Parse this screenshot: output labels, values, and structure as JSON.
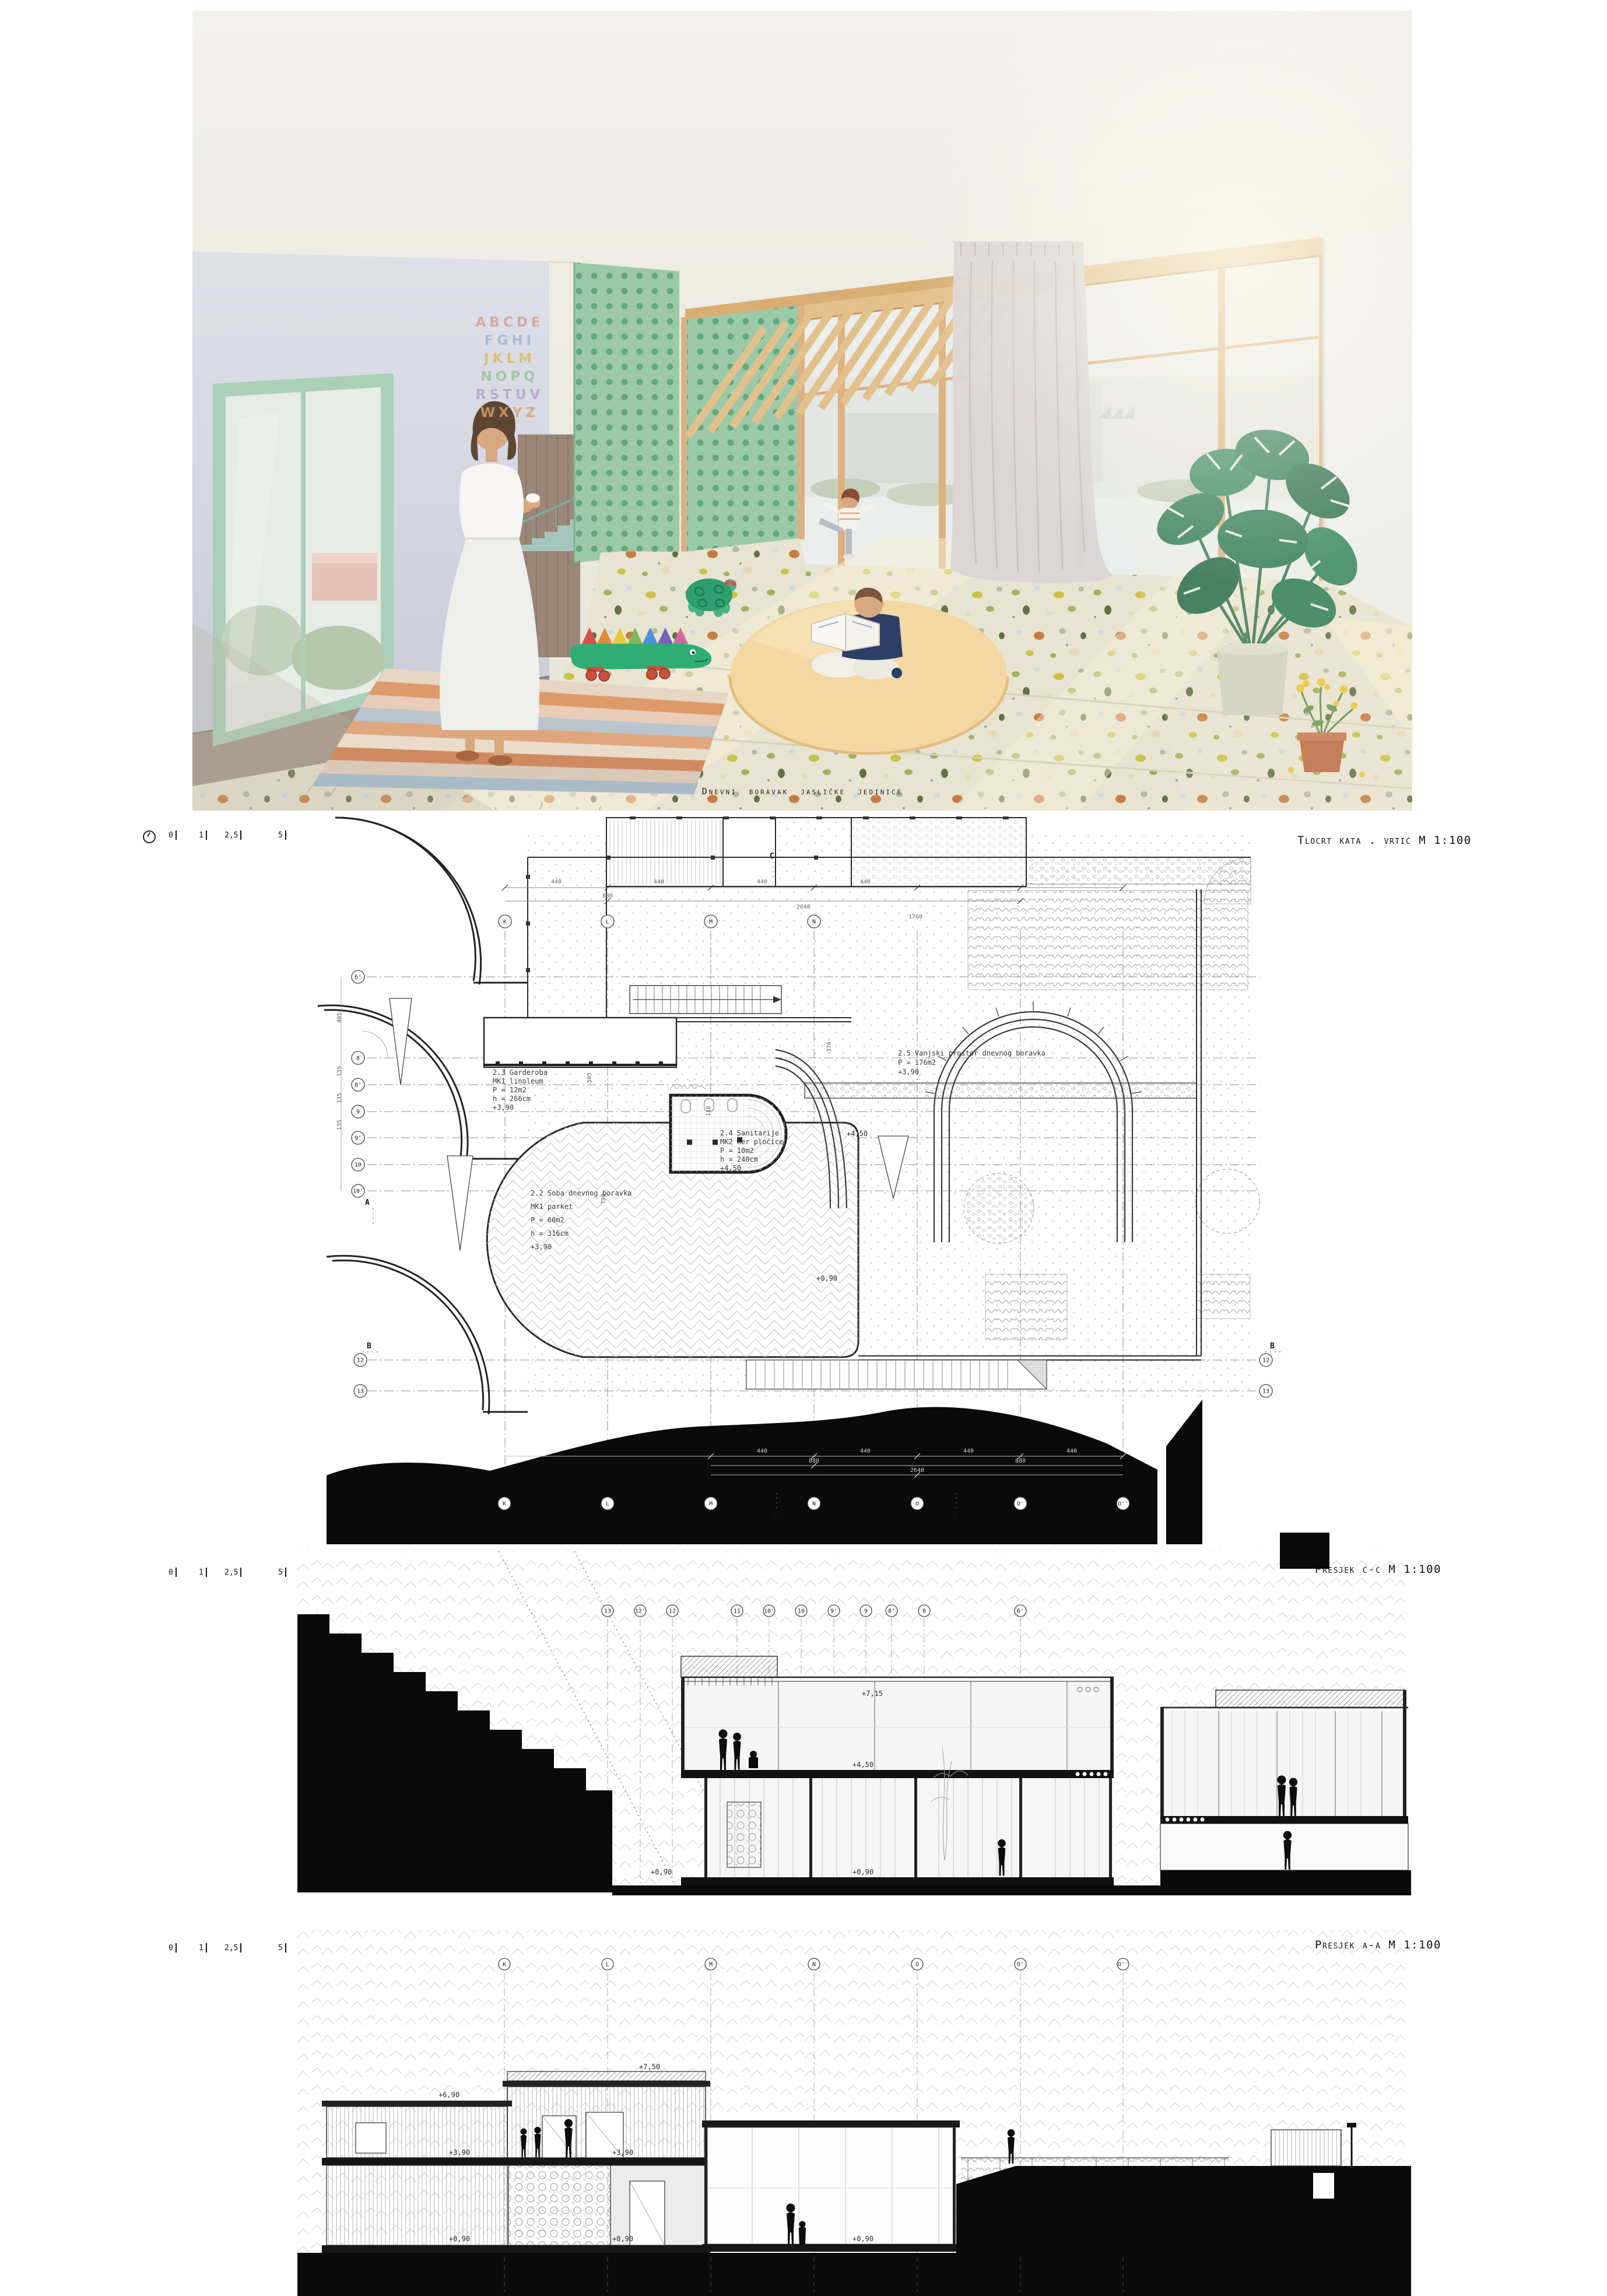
{
  "palette": {
    "green_tile": "#9ccaa8",
    "green_dot": "#63a87e",
    "wood_beam": "#e3c18d",
    "wood_wall": "#9b8678",
    "mint_frame": "#abcfb8",
    "lavender_wall": "#d8dae3",
    "terrazzo_base": "#e8e4d2",
    "curtain": "#dbd6d5",
    "rug_peach": "#f3d8a4",
    "croc_green": "#2fae74",
    "poche_black": "#0a0a0a",
    "line_dark": "#222222",
    "skin": "#d8a87f",
    "hair_brown": "#5d4634"
  },
  "render": {
    "caption": "Dnevni boravak jasličke jedinice",
    "alphabet_rows": [
      "ABCDE",
      "FGHI",
      "JKLM",
      "NOPQ",
      "RSTUV",
      "WXYZ"
    ]
  },
  "plan": {
    "title": "Tlocrt kata . vrtić M 1:100",
    "scalebar": {
      "t0": "0",
      "t1": "1",
      "t2": "2,5",
      "t3": "5"
    },
    "rooms": {
      "garderoba": {
        "l1": "2.3 Garderoba",
        "l2": "MK1 linoleum",
        "l3": "P = 12m2",
        "l4": "h = 266cm",
        "l5": "+3,90"
      },
      "soba": {
        "l1": "2.2 Soba dnevnog boravka",
        "l2": "MK1 parket",
        "l3": "P = 60m2",
        "l4": "h = 316cm",
        "l5": "+3,90"
      },
      "sanitarije": {
        "l1": "2.4 Sanitarije",
        "l2": "MK2 ker pločice",
        "l3": "P = 10m2",
        "l4": "h = 240cm",
        "l5": "+4,50"
      },
      "vanjski": {
        "l1": "2.5 Vanjski prostor dnevnog boravka",
        "l2": "P = 176m2",
        "l3": "+3,90"
      }
    },
    "levels": {
      "l450": "+4,50",
      "l090": "+0,90"
    },
    "grid_top": [
      "K",
      "L",
      "M",
      "N"
    ],
    "grid_bottom": [
      "K",
      "L",
      "M",
      "N",
      "O",
      "O'",
      "O''"
    ],
    "grid_left": [
      "6'",
      "8",
      "8'",
      "9",
      "9'",
      "10",
      "10'"
    ],
    "grid_lr": {
      "n12": "12",
      "n13": "13"
    },
    "dims": {
      "d440": "440",
      "d880": "880",
      "d2640": "2640",
      "d1760": "1760",
      "d405": "405",
      "d135": "135",
      "d505": "505",
      "d118": "118",
      "d790": "790",
      "d376": "376"
    },
    "cuts": {
      "a": "A",
      "b": "B",
      "c": "C",
      "d": "D"
    }
  },
  "section_cc": {
    "title": "Presjek c-c M 1:100",
    "scalebar": {
      "t0": "0",
      "t1": "1",
      "t2": "2,5",
      "t3": "5"
    },
    "grid": [
      "13",
      "12'",
      "12",
      "11",
      "10'",
      "10",
      "9'",
      "9",
      "8'",
      "8",
      "6'"
    ],
    "levels": {
      "l715": "+7,15",
      "l450": "+4,50",
      "l090": "+0,90"
    }
  },
  "section_aa": {
    "title": "Presjek a-a M 1:100",
    "scalebar": {
      "t0": "0",
      "t1": "1",
      "t2": "2,5",
      "t3": "5"
    },
    "grid": [
      "K",
      "L",
      "M",
      "N",
      "O",
      "O'",
      "O''"
    ],
    "levels": {
      "l750": "+7,50",
      "l690": "+6,90",
      "l390": "+3,90",
      "l090": "+0,90"
    }
  }
}
